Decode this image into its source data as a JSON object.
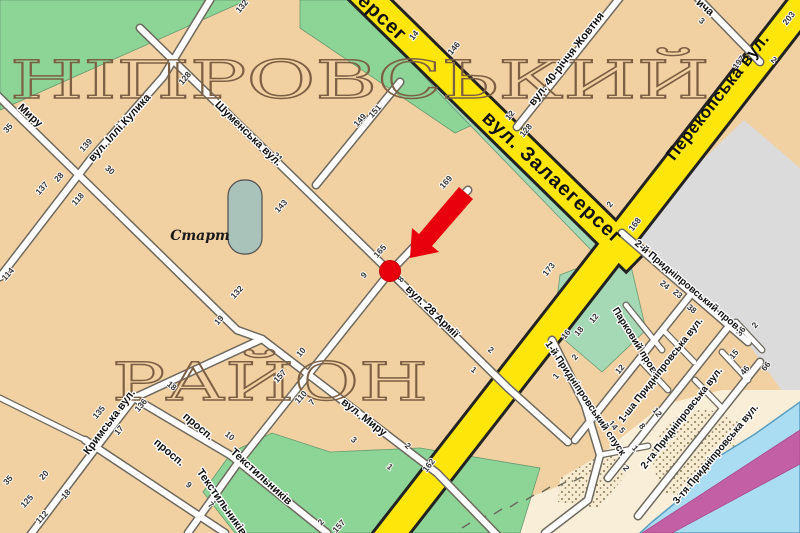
{
  "map": {
    "title": "Дніпровський район — фрагмент мапи міста",
    "colors": {
      "background": "#f1d0a1",
      "road_major": "#ffe60a",
      "street_fill": "#ffffff",
      "park_green": "#8dd497",
      "park_green_soft": "#a5d8b5",
      "water": "#aadcf2",
      "breakwater_pink": "#c35fa4",
      "sand": "#f9efd8",
      "grey_area": "#dbdbdb",
      "stadium": "#a9c3bb",
      "marker_red": "#e8000d"
    },
    "district_words": [
      {
        "text": "НІПРОВСЬКИЙ",
        "x": 10,
        "y": 98,
        "spread": 700,
        "size": 52
      },
      {
        "text": "РАЙОН",
        "x": 112,
        "y": 400,
        "spread": 316,
        "size": 52
      }
    ],
    "street_labels": [
      {
        "text": "ерсег",
        "x": 378,
        "y": 22,
        "rot": 43,
        "cls": "road-major"
      },
      {
        "text": "вул. Залаегерсег",
        "x": 548,
        "y": 182,
        "rot": 43,
        "cls": "road-major"
      },
      {
        "text": "Перекопська вул.",
        "x": 722,
        "y": 100,
        "rot": -52,
        "cls": "road-major2"
      },
      {
        "text": "вул. 40-річчя Жовтня",
        "x": 569,
        "y": 61,
        "rot": -52,
        "cls": ""
      },
      {
        "text": "ича",
        "x": 703,
        "y": 10,
        "rot": 40,
        "cls": ""
      },
      {
        "text": "Миру",
        "x": 28,
        "y": 118,
        "rot": 42,
        "cls": ""
      },
      {
        "text": "вул. Іллі Кулика",
        "x": 122,
        "y": 130,
        "rot": -48,
        "cls": ""
      },
      {
        "text": "Шуменська вул.",
        "x": 246,
        "y": 136,
        "rot": 44,
        "cls": ""
      },
      {
        "text": "вул. 28 Армії",
        "x": 430,
        "y": 314,
        "rot": 44,
        "cls": ""
      },
      {
        "text": "вул. Миру",
        "x": 362,
        "y": 420,
        "rot": 38,
        "cls": ""
      },
      {
        "text": "Кримська вул.",
        "x": 112,
        "y": 424,
        "rot": -53,
        "cls": ""
      },
      {
        "text": "просп.",
        "x": 196,
        "y": 429,
        "rot": 40,
        "cls": ""
      },
      {
        "text": "Текстильників",
        "x": 259,
        "y": 479,
        "rot": 42,
        "cls": ""
      },
      {
        "text": "просп.",
        "x": 167,
        "y": 455,
        "rot": 40,
        "cls": ""
      },
      {
        "text": "Текстильників",
        "x": 219,
        "y": 504,
        "rot": 55,
        "cls": ""
      },
      {
        "text": "1-й Придніпровський спуск",
        "x": 583,
        "y": 400,
        "rot": 56,
        "cls": "sm"
      },
      {
        "text": "2-й Придніпровський пров.",
        "x": 686,
        "y": 288,
        "rot": 40,
        "cls": "sm"
      },
      {
        "text": "Парковий пров.",
        "x": 633,
        "y": 343,
        "rot": 58,
        "cls": "sm"
      },
      {
        "text": "1-ша Придніпровська вул.",
        "x": 663,
        "y": 372,
        "rot": -52,
        "cls": "sm"
      },
      {
        "text": "2-га Придніпровська вул.",
        "x": 684,
        "y": 420,
        "rot": -52,
        "cls": "sm"
      },
      {
        "text": "3-тя Придніпровська вул.",
        "x": 718,
        "y": 456,
        "rot": -50,
        "cls": "sm"
      }
    ],
    "poi_labels": [
      {
        "text": "Старт",
        "x": 200,
        "y": 240,
        "rot": 0
      }
    ],
    "marker": {
      "description": "red arrow pointing to red location dot at the corner of вул. 28 Армії",
      "dot_x": 390,
      "dot_y": 271
    },
    "house_numbers": [
      {
        "t": "132",
        "x": 244,
        "y": 8,
        "r": -50
      },
      {
        "t": "128",
        "x": 187,
        "y": 80,
        "r": -50
      },
      {
        "t": "139",
        "x": 88,
        "y": 147,
        "r": -48
      },
      {
        "t": "35",
        "x": 10,
        "y": 130,
        "r": -48
      },
      {
        "t": "30",
        "x": 108,
        "y": 172,
        "r": 42
      },
      {
        "t": "28",
        "x": 61,
        "y": 179,
        "r": -48
      },
      {
        "t": "137",
        "x": 44,
        "y": 190,
        "r": -48
      },
      {
        "t": "118",
        "x": 80,
        "y": 201,
        "r": -48
      },
      {
        "t": "114",
        "x": 10,
        "y": 276,
        "r": -48
      },
      {
        "t": "21",
        "x": 276,
        "y": 159,
        "r": 42
      },
      {
        "t": "143",
        "x": 283,
        "y": 208,
        "r": -48
      },
      {
        "t": "132",
        "x": 239,
        "y": 294,
        "r": -48
      },
      {
        "t": "19",
        "x": 221,
        "y": 322,
        "r": -48
      },
      {
        "t": "149",
        "x": 362,
        "y": 122,
        "r": -48
      },
      {
        "t": "151",
        "x": 377,
        "y": 113,
        "r": -48
      },
      {
        "t": "146",
        "x": 456,
        "y": 50,
        "r": -50
      },
      {
        "t": "14",
        "x": 416,
        "y": 37,
        "r": -50
      },
      {
        "t": "12",
        "x": 512,
        "y": 117,
        "r": -50
      },
      {
        "t": "128",
        "x": 528,
        "y": 132,
        "r": -50
      },
      {
        "t": "3",
        "x": 700,
        "y": 23,
        "r": 40
      },
      {
        "t": "203",
        "x": 791,
        "y": 20,
        "r": -52
      },
      {
        "t": "197",
        "x": 741,
        "y": 64,
        "r": -52
      },
      {
        "t": "2",
        "x": 772,
        "y": 62,
        "r": 40
      },
      {
        "t": "2",
        "x": 612,
        "y": 206,
        "r": -52
      },
      {
        "t": "168",
        "x": 637,
        "y": 226,
        "r": -52
      },
      {
        "t": "169",
        "x": 448,
        "y": 184,
        "r": -48
      },
      {
        "t": "165",
        "x": 382,
        "y": 253,
        "r": -48
      },
      {
        "t": "173",
        "x": 551,
        "y": 271,
        "r": -52
      },
      {
        "t": "9",
        "x": 366,
        "y": 277,
        "r": -48
      },
      {
        "t": "8",
        "x": 403,
        "y": 281,
        "r": -48
      },
      {
        "t": "10",
        "x": 303,
        "y": 354,
        "r": -48
      },
      {
        "t": "157",
        "x": 282,
        "y": 378,
        "r": -48
      },
      {
        "t": "110",
        "x": 303,
        "y": 399,
        "r": -48
      },
      {
        "t": "7",
        "x": 314,
        "y": 404,
        "r": -48
      },
      {
        "t": "2",
        "x": 489,
        "y": 352,
        "r": 40
      },
      {
        "t": "1",
        "x": 472,
        "y": 372,
        "r": 40
      },
      {
        "t": "3",
        "x": 352,
        "y": 442,
        "r": 42
      },
      {
        "t": "2",
        "x": 406,
        "y": 448,
        "r": 42
      },
      {
        "t": "1",
        "x": 388,
        "y": 469,
        "r": 42
      },
      {
        "t": "162",
        "x": 431,
        "y": 467,
        "r": -52
      },
      {
        "t": "135",
        "x": 101,
        "y": 414,
        "r": -50
      },
      {
        "t": "136",
        "x": 143,
        "y": 407,
        "r": -50
      },
      {
        "t": "17",
        "x": 121,
        "y": 432,
        "r": -50
      },
      {
        "t": "18",
        "x": 170,
        "y": 388,
        "r": 40
      },
      {
        "t": "10",
        "x": 228,
        "y": 438,
        "r": 40
      },
      {
        "t": "9",
        "x": 187,
        "y": 487,
        "r": 40
      },
      {
        "t": "7",
        "x": 209,
        "y": 507,
        "r": 40
      },
      {
        "t": "20",
        "x": 46,
        "y": 477,
        "r": -48
      },
      {
        "t": "18",
        "x": 68,
        "y": 496,
        "r": -48
      },
      {
        "t": "35",
        "x": 10,
        "y": 482,
        "r": -48
      },
      {
        "t": "125",
        "x": 29,
        "y": 503,
        "r": -48
      },
      {
        "t": "112",
        "x": 44,
        "y": 519,
        "r": -48
      },
      {
        "t": "2",
        "x": 323,
        "y": 524,
        "r": -48
      },
      {
        "t": "157",
        "x": 341,
        "y": 528,
        "r": -48
      },
      {
        "t": "18",
        "x": 581,
        "y": 333,
        "r": -50
      },
      {
        "t": "16",
        "x": 568,
        "y": 336,
        "r": -50
      },
      {
        "t": "12",
        "x": 596,
        "y": 320,
        "r": -50
      },
      {
        "t": "2",
        "x": 577,
        "y": 359,
        "r": -50
      },
      {
        "t": "1",
        "x": 558,
        "y": 378,
        "r": -50
      },
      {
        "t": "24",
        "x": 663,
        "y": 287,
        "r": 40
      },
      {
        "t": "23",
        "x": 676,
        "y": 296,
        "r": 40
      },
      {
        "t": "38",
        "x": 690,
        "y": 311,
        "r": 40
      },
      {
        "t": "1",
        "x": 645,
        "y": 363,
        "r": -50
      },
      {
        "t": "12",
        "x": 622,
        "y": 371,
        "r": -50
      },
      {
        "t": "36",
        "x": 743,
        "y": 333,
        "r": -50
      },
      {
        "t": "2",
        "x": 757,
        "y": 327,
        "r": -50
      },
      {
        "t": "15",
        "x": 736,
        "y": 356,
        "r": -50
      },
      {
        "t": "66",
        "x": 768,
        "y": 368,
        "r": -50
      },
      {
        "t": "46",
        "x": 747,
        "y": 372,
        "r": -50
      },
      {
        "t": "14",
        "x": 611,
        "y": 427,
        "r": 50
      },
      {
        "t": "5",
        "x": 620,
        "y": 432,
        "r": 50
      },
      {
        "t": "8",
        "x": 640,
        "y": 428,
        "r": 50
      },
      {
        "t": "12",
        "x": 655,
        "y": 414,
        "r": 50
      },
      {
        "t": "1",
        "x": 633,
        "y": 450,
        "r": 50
      },
      {
        "t": "2",
        "x": 624,
        "y": 470,
        "r": 50
      }
    ]
  }
}
